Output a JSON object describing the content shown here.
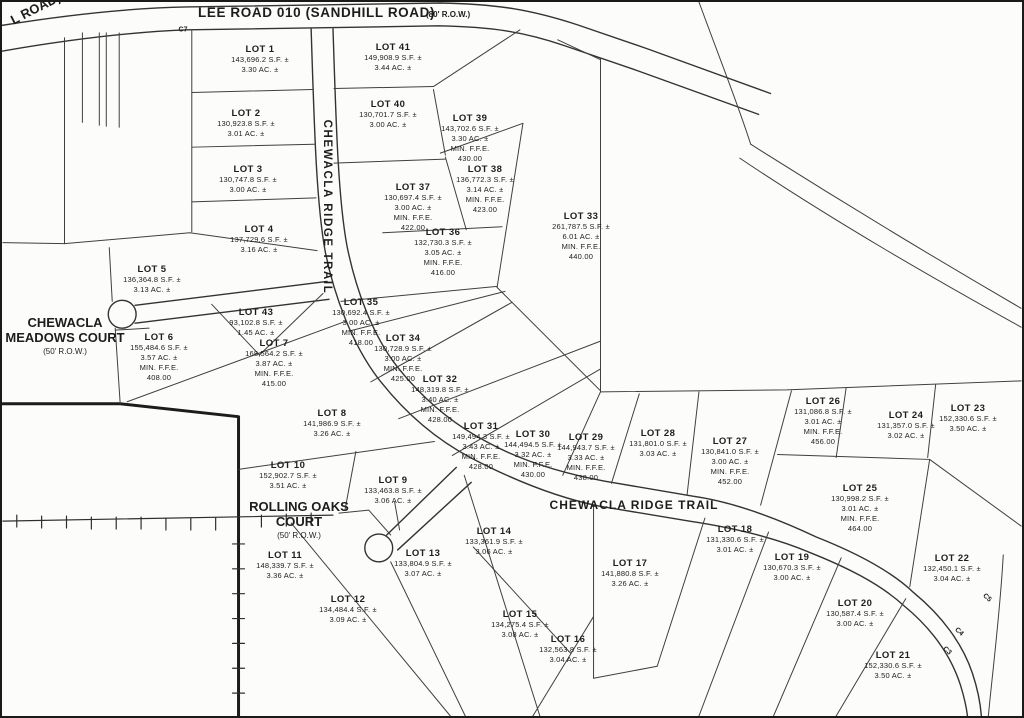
{
  "roads": {
    "lee_road": {
      "name": "LEE ROAD 010 (SANDHILL ROAD)",
      "row": "(80' R.O.W.)"
    },
    "left_road_partial": "L ROAD)",
    "ridge_trail": "CHEWACLA RIDGE TRAIL",
    "meadows_court": {
      "line1": "CHEWACLA",
      "line2": "MEADOWS COURT",
      "row": "(50' R.O.W.)"
    },
    "rolling_oaks_court": {
      "line1": "ROLLING OAKS",
      "line2": "COURT",
      "row": "(50' R.O.W.)"
    }
  },
  "labels": {
    "min_ffe": "MIN. F.F.E."
  },
  "curve_labels": [
    {
      "text": "C7",
      "x": 181,
      "y": 28,
      "rot": 0
    },
    {
      "text": "C5",
      "x": 985,
      "y": 596,
      "rot": 42
    },
    {
      "text": "C4",
      "x": 957,
      "y": 630,
      "rot": 42
    },
    {
      "text": "C3",
      "x": 945,
      "y": 649,
      "rot": 42
    }
  ],
  "lots": [
    {
      "name": "LOT 1",
      "sf": "143,696.2 S.F. ±",
      "ac": "3.30 AC. ±",
      "ffe": null,
      "x": 258,
      "y": 42
    },
    {
      "name": "LOT 2",
      "sf": "130,923.8 S.F. ±",
      "ac": "3.01 AC. ±",
      "ffe": null,
      "x": 244,
      "y": 106
    },
    {
      "name": "LOT 3",
      "sf": "130,747.8 S.F. ±",
      "ac": "3.00 AC. ±",
      "ffe": null,
      "x": 246,
      "y": 162
    },
    {
      "name": "LOT 4",
      "sf": "137,729.6 S.F. ±",
      "ac": "3.16 AC. ±",
      "ffe": null,
      "x": 257,
      "y": 222
    },
    {
      "name": "LOT 5",
      "sf": "136,364.8 S.F. ±",
      "ac": "3.13 AC. ±",
      "ffe": null,
      "x": 150,
      "y": 262
    },
    {
      "name": "LOT 6",
      "sf": "155,484.6 S.F. ±",
      "ac": "3.57 AC. ±",
      "ffe": "408.00",
      "x": 157,
      "y": 330
    },
    {
      "name": "LOT 7",
      "sf": "168,564.2 S.F. ±",
      "ac": "3.87 AC. ±",
      "ffe": "415.00",
      "x": 272,
      "y": 336
    },
    {
      "name": "LOT 8",
      "sf": "141,986.9 S.F. ±",
      "ac": "3.26 AC. ±",
      "ffe": null,
      "x": 330,
      "y": 406
    },
    {
      "name": "LOT 9",
      "sf": "133,463.8 S.F. ±",
      "ac": "3.06 AC. ±",
      "ffe": null,
      "x": 391,
      "y": 473
    },
    {
      "name": "LOT 10",
      "sf": "152,902.7 S.F. ±",
      "ac": "3.51 AC. ±",
      "ffe": null,
      "x": 286,
      "y": 458
    },
    {
      "name": "LOT 11",
      "sf": "148,339.7 S.F. ±",
      "ac": "3.36 AC. ±",
      "ffe": null,
      "x": 283,
      "y": 548
    },
    {
      "name": "LOT 12",
      "sf": "134,484.4 S.F. ±",
      "ac": "3.09 AC. ±",
      "ffe": null,
      "x": 346,
      "y": 592
    },
    {
      "name": "LOT 13",
      "sf": "133,804.9 S.F. ±",
      "ac": "3.07 AC. ±",
      "ffe": null,
      "x": 421,
      "y": 546
    },
    {
      "name": "LOT 14",
      "sf": "133,361.9 S.F. ±",
      "ac": "3.06 AC. ±",
      "ffe": null,
      "x": 492,
      "y": 524
    },
    {
      "name": "LOT 15",
      "sf": "134,275.4 S.F. ±",
      "ac": "3.08 AC. ±",
      "ffe": null,
      "x": 518,
      "y": 607
    },
    {
      "name": "LOT 16",
      "sf": "132,563.8 S.F. ±",
      "ac": "3.04 AC. ±",
      "ffe": null,
      "x": 566,
      "y": 632
    },
    {
      "name": "LOT 17",
      "sf": "141,880.8 S.F. ±",
      "ac": "3.26 AC. ±",
      "ffe": null,
      "x": 628,
      "y": 556
    },
    {
      "name": "LOT 18",
      "sf": "131,330.6 S.F. ±",
      "ac": "3.01 AC. ±",
      "ffe": null,
      "x": 733,
      "y": 522
    },
    {
      "name": "LOT 19",
      "sf": "130,670.3 S.F. ±",
      "ac": "3.00 AC. ±",
      "ffe": null,
      "x": 790,
      "y": 550
    },
    {
      "name": "LOT 20",
      "sf": "130,587.4 S.F. ±",
      "ac": "3.00 AC. ±",
      "ffe": null,
      "x": 853,
      "y": 596
    },
    {
      "name": "LOT 21",
      "sf": "152,330.6 S.F. ±",
      "ac": "3.50 AC. ±",
      "ffe": null,
      "x": 891,
      "y": 648
    },
    {
      "name": "LOT 22",
      "sf": "132,450.1 S.F. ±",
      "ac": "3.04 AC. ±",
      "ffe": null,
      "x": 950,
      "y": 551
    },
    {
      "name": "LOT 23",
      "sf": "152,330.6 S.F. ±",
      "ac": "3.50 AC. ±",
      "ffe": null,
      "x": 966,
      "y": 401
    },
    {
      "name": "LOT 24",
      "sf": "131,357.0 S.F. ±",
      "ac": "3.02 AC. ±",
      "ffe": null,
      "x": 904,
      "y": 408
    },
    {
      "name": "LOT 25",
      "sf": "130,998.2 S.F. ±",
      "ac": "3.01 AC. ±",
      "ffe": "464.00",
      "x": 858,
      "y": 481
    },
    {
      "name": "LOT 26",
      "sf": "131,086.8 S.F. ±",
      "ac": "3.01 AC. ±",
      "ffe": "456.00",
      "x": 821,
      "y": 394
    },
    {
      "name": "LOT 27",
      "sf": "130,841.0 S.F. ±",
      "ac": "3.00 AC. ±",
      "ffe": "452.00",
      "x": 728,
      "y": 434
    },
    {
      "name": "LOT 28",
      "sf": "131,801.0 S.F. ±",
      "ac": "3.03 AC. ±",
      "ffe": null,
      "x": 656,
      "y": 426
    },
    {
      "name": "LOT 29",
      "sf": "144,943.7 S.F. ±",
      "ac": "3.33 AC. ±",
      "ffe": "438.00",
      "x": 584,
      "y": 430
    },
    {
      "name": "LOT 30",
      "sf": "144,494.5 S.F. ±",
      "ac": "3.32 AC. ±",
      "ffe": "430.00",
      "x": 531,
      "y": 427
    },
    {
      "name": "LOT 31",
      "sf": "149,494.3 S.F. ±",
      "ac": "3.43 AC. ±",
      "ffe": "428.00",
      "x": 479,
      "y": 419
    },
    {
      "name": "LOT 32",
      "sf": "148,319.8 S.F. ±",
      "ac": "3.40 AC. ±",
      "ffe": "428.00",
      "x": 438,
      "y": 372
    },
    {
      "name": "LOT 33",
      "sf": "261,787.5 S.F. ±",
      "ac": "6.01 AC. ±",
      "ffe": "440.00",
      "x": 579,
      "y": 209
    },
    {
      "name": "LOT 34",
      "sf": "130,728.9 S.F. ±",
      "ac": "3.00 AC. ±",
      "ffe": "425.00",
      "x": 401,
      "y": 331
    },
    {
      "name": "LOT 35",
      "sf": "130,692.4 S.F. ±",
      "ac": "3.00 AC. ±",
      "ffe": "418.00",
      "x": 359,
      "y": 295
    },
    {
      "name": "LOT 36",
      "sf": "132,730.3 S.F. ±",
      "ac": "3.05 AC. ±",
      "ffe": "416.00",
      "x": 441,
      "y": 225
    },
    {
      "name": "LOT 37",
      "sf": "130,697.4 S.F. ±",
      "ac": "3.00 AC. ±",
      "ffe": "422.00",
      "x": 411,
      "y": 180
    },
    {
      "name": "LOT 38",
      "sf": "136,772.3 S.F. ±",
      "ac": "3.14 AC. ±",
      "ffe": "423.00",
      "x": 483,
      "y": 162
    },
    {
      "name": "LOT 39",
      "sf": "143,702.6 S.F. ±",
      "ac": "3.30 AC. ±",
      "ffe": "430.00",
      "x": 468,
      "y": 111
    },
    {
      "name": "LOT 40",
      "sf": "130,701.7 S.F. ±",
      "ac": "3.00 AC. ±",
      "ffe": null,
      "x": 386,
      "y": 97
    },
    {
      "name": "LOT 41",
      "sf": "149,908.9 S.F. ±",
      "ac": "3.44 AC. ±",
      "ffe": null,
      "x": 391,
      "y": 40
    },
    {
      "name": "LOT 43",
      "sf": "93,102.8 S.F. ±",
      "ac": "1.45 AC. ±",
      "ffe": null,
      "x": 254,
      "y": 305
    }
  ]
}
